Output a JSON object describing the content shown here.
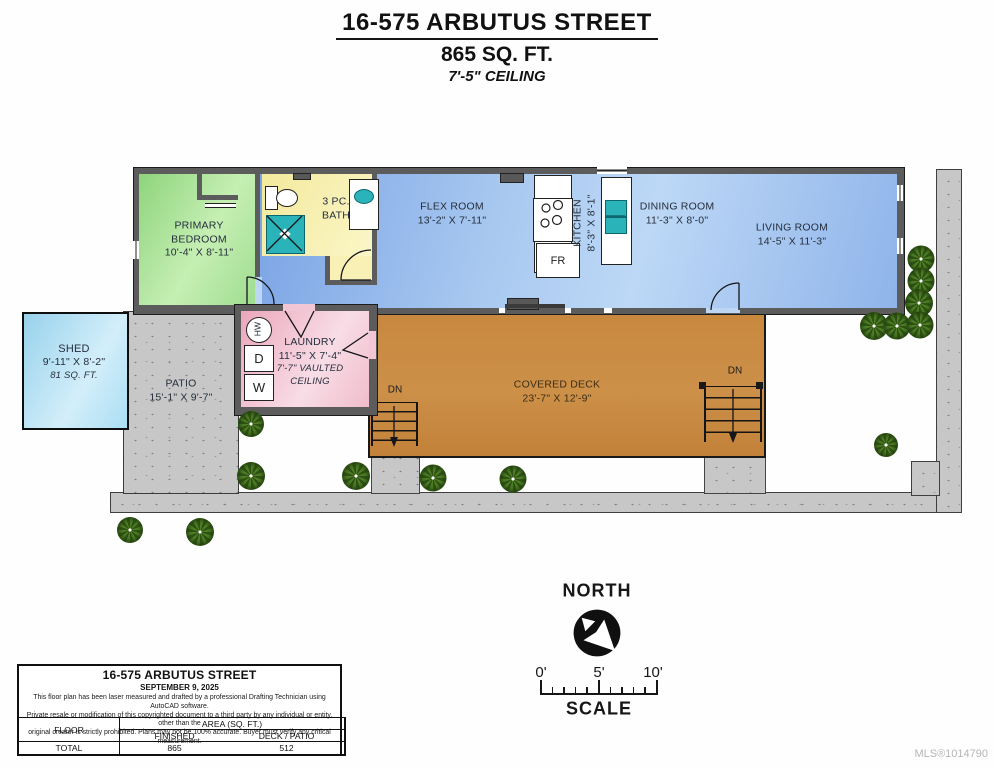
{
  "title": {
    "address": "16-575 ARBUTUS STREET",
    "area": "865 SQ. FT.",
    "ceiling": "7'-5\" CEILING"
  },
  "rooms": {
    "primary_bedroom": {
      "line1": "PRIMARY",
      "line2": "BEDROOM",
      "dims": "10'-4\" X 8'-11\""
    },
    "bath": {
      "line1": "3 PC.",
      "line2": "BATH"
    },
    "flex": {
      "name": "FLEX ROOM",
      "dims": "13'-2\" X 7'-11\""
    },
    "kitchen": {
      "name": "KITCHEN",
      "dims": "8'-3\" X 8'-1\""
    },
    "dining": {
      "name": "DINING ROOM",
      "dims": "11'-3\" X 8'-0\""
    },
    "living": {
      "name": "LIVING ROOM",
      "dims": "14'-5\" X 11'-3\""
    },
    "laundry": {
      "name": "LAUNDRY",
      "dims": "11'-5\" X 7'-4\"",
      "note1": "7'-7\" VAULTED",
      "note2": "CEILING"
    },
    "shed": {
      "name": "SHED",
      "dims": "9'-11\" X 8'-2\"",
      "area": "81 SQ. FT."
    },
    "patio": {
      "name": "PATIO",
      "dims": "15'-1\" X 9'-7\""
    },
    "deck": {
      "name": "COVERED DECK",
      "dims": "23'-7\" X 12'-9\""
    }
  },
  "fixtures": {
    "fridge": "FR",
    "dryer": "D",
    "washer": "W",
    "hot_water": "HW"
  },
  "stairs": {
    "left_dn": "DN",
    "right_dn": "DN"
  },
  "compass": {
    "label": "NORTH"
  },
  "scalebar": {
    "t0": "0'",
    "t5": "5'",
    "t10": "10'",
    "label": "SCALE"
  },
  "info_box": {
    "address": "16-575 ARBUTUS STREET",
    "date": "SEPTEMBER 9, 2025",
    "disclaimer1": "This floor plan has been laser measured and drafted by a professional Drafting Technician using AutoCAD software.",
    "disclaimer2": "Private resale or modification of this copyrighted document to a third party by any individual or entity, other than the",
    "disclaimer3": "original creator is strictly prohibited. Plans may not be 100% accurate.  Buyer must verify any critical measurement.",
    "table": {
      "floor": "FLOOR",
      "area_header": "AREA (SQ. FT.)",
      "finished": "FINISHED",
      "deck_patio": "DECK / PATIO",
      "total": "TOTAL",
      "finished_value": "865",
      "deck_patio_value": "512"
    }
  },
  "watermark": "MLS®1014790",
  "colors": {
    "bedroom_green": "#9ede8e",
    "bath_yellow": "#f6efad",
    "main_blue": "#8fb4ea",
    "laundry_pink": "#efb4c5",
    "shed_blue": "#a9dcf3",
    "deck_brown": "#c8883e",
    "patio_gray": "#c7c7c7",
    "fixture_teal": "#2ab3b8",
    "wall_gray": "#5c5c5c"
  }
}
